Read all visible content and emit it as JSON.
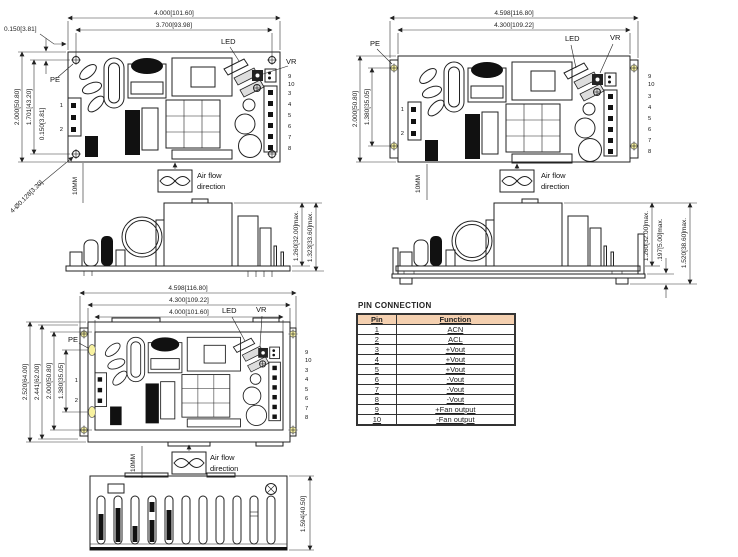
{
  "shared": {
    "pe": "PE",
    "led": "LED",
    "vr": "VR",
    "clearance": "10MM",
    "airflow_line1": "Air flow",
    "airflow_line2": "direction",
    "pins_left": [
      "1",
      "2"
    ],
    "pins_fan": [
      "9",
      "10"
    ],
    "pins_out": [
      "3",
      "4",
      "5",
      "6",
      "7",
      "8"
    ]
  },
  "views": {
    "pcb_top": {
      "dims": {
        "width_outer": "4.000[101.60]",
        "width_holes": "3.700[93.98]",
        "hole_offset_top": "0.150[3.81]",
        "height_outer": "2.000[50.80]",
        "height_holes": "1.701[43.20]",
        "hole_offset_left": "0.150[3.81]",
        "mounting_holes": "4-Ø0.128[3.20]"
      }
    },
    "chassis_top": {
      "dims": {
        "width_outer": "4.598[116.80]",
        "width_inner": "4.300[109.22]",
        "height_outer": "2.000[50.80]",
        "height_slots": "1.380[35.05]"
      }
    },
    "pcb_side": {
      "dims": {
        "component_height": "1.260[32.00]max.",
        "total_height": "1.323[33.60]max."
      }
    },
    "chassis_side": {
      "dims": {
        "component_height": "1.260[32.00]max.",
        "standoff": ".197[5.00]max.",
        "total_height": "1.520[38.60]max."
      }
    },
    "chassis_full_top": {
      "dims": {
        "width_outer": "4.598[116.80]",
        "width_inner": "4.300[109.22]",
        "width_pcb": "4.000[101.60]",
        "depth_outer": "2.520[64.00]",
        "depth_holes": "2.441[62.00]",
        "depth_pcb": "2.000[50.80]",
        "depth_slots": "1.380[35.05]"
      }
    },
    "front": {
      "dims": {
        "height": "1.594[40.50]"
      }
    }
  },
  "pin_table": {
    "title": "PIN CONNECTION",
    "headers": {
      "pin": "Pin",
      "function": "Function"
    },
    "rows": [
      {
        "pin": "1",
        "function": "ACN"
      },
      {
        "pin": "2",
        "function": "ACL"
      },
      {
        "pin": "3",
        "function": "+Vout"
      },
      {
        "pin": "4",
        "function": "+Vout"
      },
      {
        "pin": "5",
        "function": "+Vout"
      },
      {
        "pin": "6",
        "function": "-Vout"
      },
      {
        "pin": "7",
        "function": "-Vout"
      },
      {
        "pin": "8",
        "function": "-Vout"
      },
      {
        "pin": "9",
        "function": "+Fan output"
      },
      {
        "pin": "10",
        "function": "-Fan output"
      }
    ]
  },
  "colors": {
    "line": "#222222",
    "hole_fill": "#f8f2a0",
    "table_header": "#f4d0b0"
  }
}
